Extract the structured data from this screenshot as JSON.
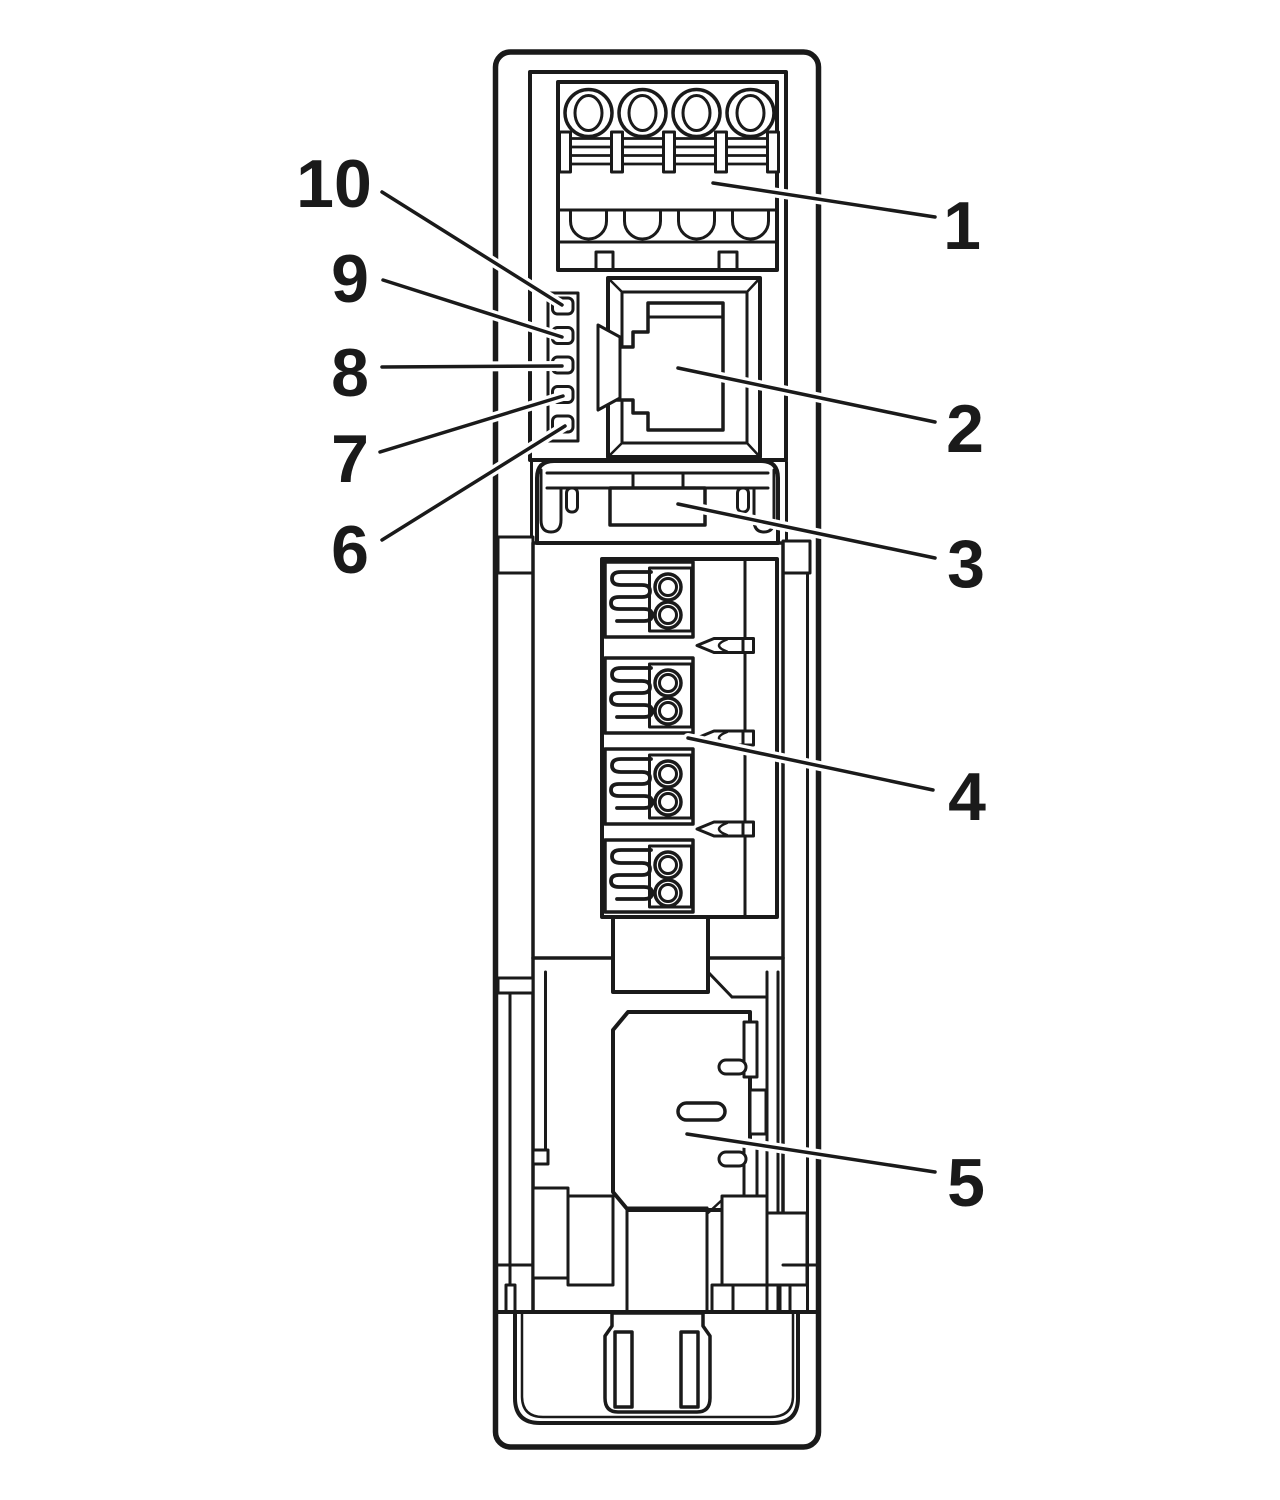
{
  "figure": {
    "type": "technical-line-diagram",
    "description": "Front view line drawing of a DIN-rail electronic module with numbered callouts",
    "background_color": "#ffffff",
    "line_color": "#1a1a1a",
    "callout_halo_color": "#ffffff"
  },
  "callouts": [
    {
      "label": "1",
      "target": "top-screw-terminal-block",
      "line": {
        "x1": 713,
        "y1": 183,
        "x2": 935,
        "y2": 217
      },
      "label_pos": {
        "x": 962,
        "y": 249
      }
    },
    {
      "label": "2",
      "target": "rj45-jack",
      "line": {
        "x1": 678,
        "y1": 368,
        "x2": 935,
        "y2": 422
      },
      "label_pos": {
        "x": 965,
        "y": 452
      }
    },
    {
      "label": "3",
      "target": "connector-latch",
      "line": {
        "x1": 678,
        "y1": 504,
        "x2": 935,
        "y2": 558
      },
      "label_pos": {
        "x": 966,
        "y": 587
      }
    },
    {
      "label": "4",
      "target": "spring-clamp-terminal-block",
      "line": {
        "x1": 688,
        "y1": 738,
        "x2": 933,
        "y2": 790
      },
      "label_pos": {
        "x": 967,
        "y": 820
      }
    },
    {
      "label": "5",
      "target": "din-rail-latch-plate",
      "line": {
        "x1": 687,
        "y1": 1134,
        "x2": 935,
        "y2": 1172
      },
      "label_pos": {
        "x": 966,
        "y": 1206
      }
    },
    {
      "label": "6",
      "target": "led-5",
      "line": {
        "x1": 382,
        "y1": 540,
        "x2": 565,
        "y2": 426
      },
      "label_pos": {
        "x": 350,
        "y": 573
      }
    },
    {
      "label": "7",
      "target": "led-4",
      "line": {
        "x1": 380,
        "y1": 452,
        "x2": 563,
        "y2": 396
      },
      "label_pos": {
        "x": 350,
        "y": 482
      }
    },
    {
      "label": "8",
      "target": "led-3",
      "line": {
        "x1": 382,
        "y1": 367,
        "x2": 562,
        "y2": 366
      },
      "label_pos": {
        "x": 350,
        "y": 396
      }
    },
    {
      "label": "9",
      "target": "led-2",
      "line": {
        "x1": 383,
        "y1": 280,
        "x2": 562,
        "y2": 337
      },
      "label_pos": {
        "x": 350,
        "y": 302
      }
    },
    {
      "label": "10",
      "target": "led-1",
      "line": {
        "x1": 382,
        "y1": 192,
        "x2": 562,
        "y2": 305
      },
      "label_pos": {
        "x": 334,
        "y": 207
      }
    }
  ],
  "parts": [
    "device-shell",
    "top-panel",
    "top-screw-terminal-block",
    "screw-terminals",
    "wire-entry-arcs",
    "led-column",
    "rj45-jack",
    "connector-latch",
    "spring-clamp-terminal-block",
    "clamp-units",
    "screwdriver-slots",
    "din-rail-latch-plate",
    "latch-slot",
    "mounting-foot",
    "foot-center-column"
  ]
}
